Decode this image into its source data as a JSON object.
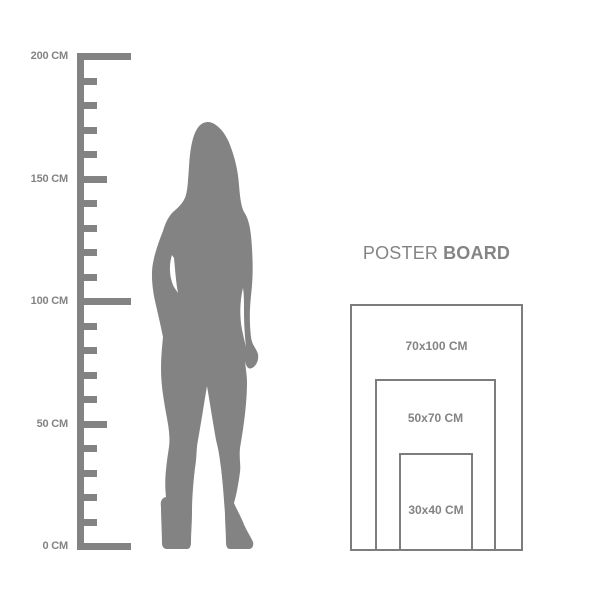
{
  "colors": {
    "background": "#ffffff",
    "silhouette_gray": "#838383",
    "ruler_gray": "#838383",
    "label_gray": "#838383",
    "rect_border_gray": "#7d7d7d",
    "title_gray": "#848484"
  },
  "ruler": {
    "unit": "CM",
    "labels": [
      {
        "text": "200 CM"
      },
      {
        "text": "150 CM"
      },
      {
        "text": "100 CM"
      },
      {
        "text": "50 CM"
      },
      {
        "text": "0 CM"
      }
    ]
  },
  "figure": {
    "description": "standing woman silhouette"
  },
  "poster_board": {
    "title_primary": "POSTER",
    "title_secondary": "BOARD",
    "sizes": [
      {
        "label": "70x100 CM",
        "width_cm": 70,
        "height_cm": 100
      },
      {
        "label": "50x70 CM",
        "width_cm": 50,
        "height_cm": 70
      },
      {
        "label": "30x40 CM",
        "width_cm": 30,
        "height_cm": 40
      }
    ]
  }
}
